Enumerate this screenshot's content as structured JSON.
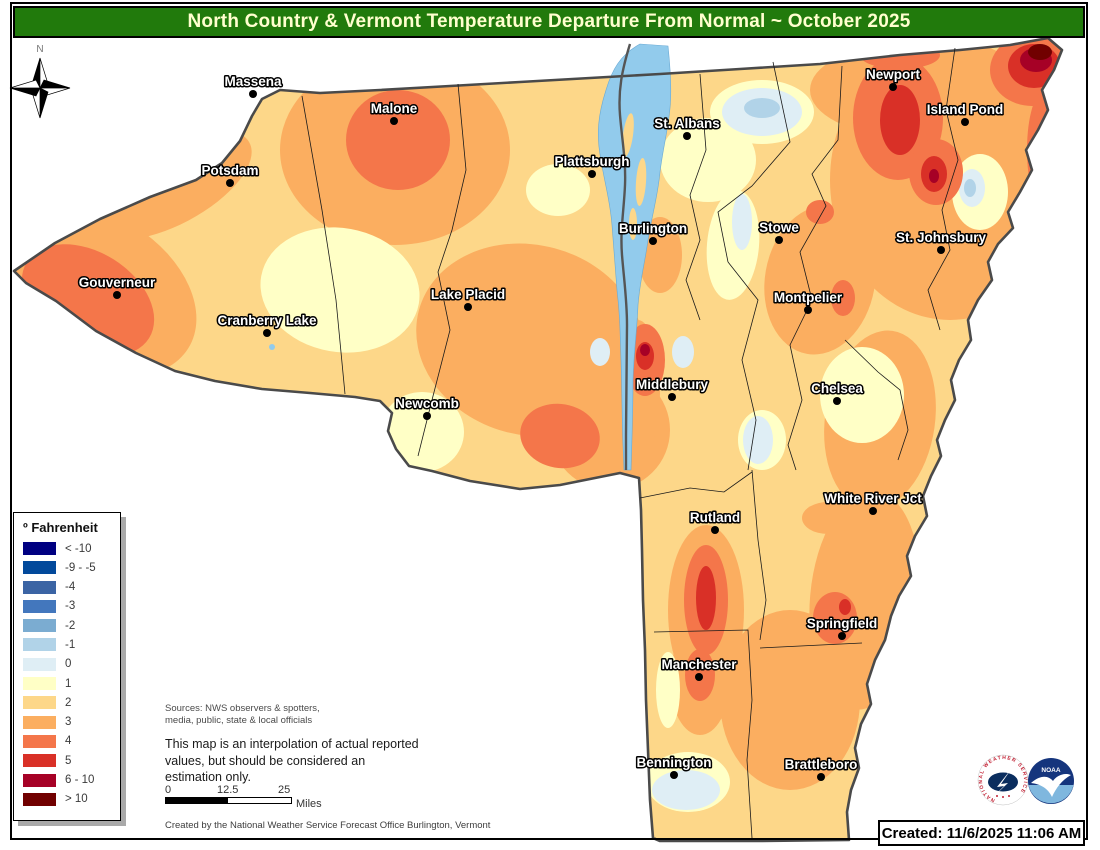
{
  "title": "North Country & Vermont Temperature Departure From Normal ~ October 2025",
  "legend": {
    "title": "º Fahrenheit",
    "items": [
      {
        "label": "< -10",
        "color": "#000081"
      },
      {
        "label": "-9 - -5",
        "color": "#02499B"
      },
      {
        "label": "-4",
        "color": "#3B64A4"
      },
      {
        "label": "-3",
        "color": "#4377BD"
      },
      {
        "label": "-2",
        "color": "#7BACD1"
      },
      {
        "label": "-1",
        "color": "#B1D3E8"
      },
      {
        "label": "0",
        "color": "#DFEEF5"
      },
      {
        "label": "1",
        "color": "#FFFFC6"
      },
      {
        "label": "2",
        "color": "#FDD789"
      },
      {
        "label": "3",
        "color": "#FBAE60"
      },
      {
        "label": "4",
        "color": "#F4764A"
      },
      {
        "label": "5",
        "color": "#D93027"
      },
      {
        "label": "6 - 10",
        "color": "#A60126"
      },
      {
        "label": "> 10",
        "color": "#710000"
      }
    ]
  },
  "map": {
    "compass_label": "N",
    "lake_color": "#92CBEC",
    "cities": [
      {
        "name": "Massena",
        "x": 253,
        "y": 94
      },
      {
        "name": "Malone",
        "x": 394,
        "y": 121
      },
      {
        "name": "Potsdam",
        "x": 230,
        "y": 183
      },
      {
        "name": "Gouverneur",
        "x": 117,
        "y": 295
      },
      {
        "name": "Cranberry Lake",
        "x": 267,
        "y": 333
      },
      {
        "name": "Lake Placid",
        "x": 468,
        "y": 307
      },
      {
        "name": "Newcomb",
        "x": 427,
        "y": 416
      },
      {
        "name": "Plattsburgh",
        "x": 592,
        "y": 174
      },
      {
        "name": "St. Albans",
        "x": 687,
        "y": 136
      },
      {
        "name": "Burlington",
        "x": 653,
        "y": 241
      },
      {
        "name": "Stowe",
        "x": 779,
        "y": 240
      },
      {
        "name": "Montpelier",
        "x": 808,
        "y": 310
      },
      {
        "name": "Middlebury",
        "x": 672,
        "y": 397
      },
      {
        "name": "Chelsea",
        "x": 837,
        "y": 401
      },
      {
        "name": "Rutland",
        "x": 715,
        "y": 530
      },
      {
        "name": "White River Jct",
        "x": 873,
        "y": 511
      },
      {
        "name": "Springfield",
        "x": 842,
        "y": 636
      },
      {
        "name": "Manchester",
        "x": 699,
        "y": 677
      },
      {
        "name": "Bennington",
        "x": 674,
        "y": 775
      },
      {
        "name": "Brattleboro",
        "x": 821,
        "y": 777
      },
      {
        "name": "Newport",
        "x": 893,
        "y": 87
      },
      {
        "name": "Island Pond",
        "x": 965,
        "y": 122
      },
      {
        "name": "St. Johnsbury",
        "x": 941,
        "y": 250
      }
    ]
  },
  "notes": {
    "sources_line1": "Sources: NWS observers & spotters,",
    "sources_line2": "media,  public,  state  &  local  officials",
    "disclaimer_line1": "This map is an interpolation of actual reported",
    "disclaimer_line2": "values, but should be considered an",
    "disclaimer_line3": "estimation only.",
    "created_by": "Created by the National Weather Service Forecast Office Burlington, Vermont"
  },
  "scalebar": {
    "start": "0",
    "mid": "12.5",
    "end": "25",
    "unit": "Miles"
  },
  "created_stamp": "Created: 11/6/2025 11:06 AM",
  "logos": {
    "nws_text": "NATIONAL WEATHER SERVICE",
    "noaa_text": "NOAA"
  }
}
